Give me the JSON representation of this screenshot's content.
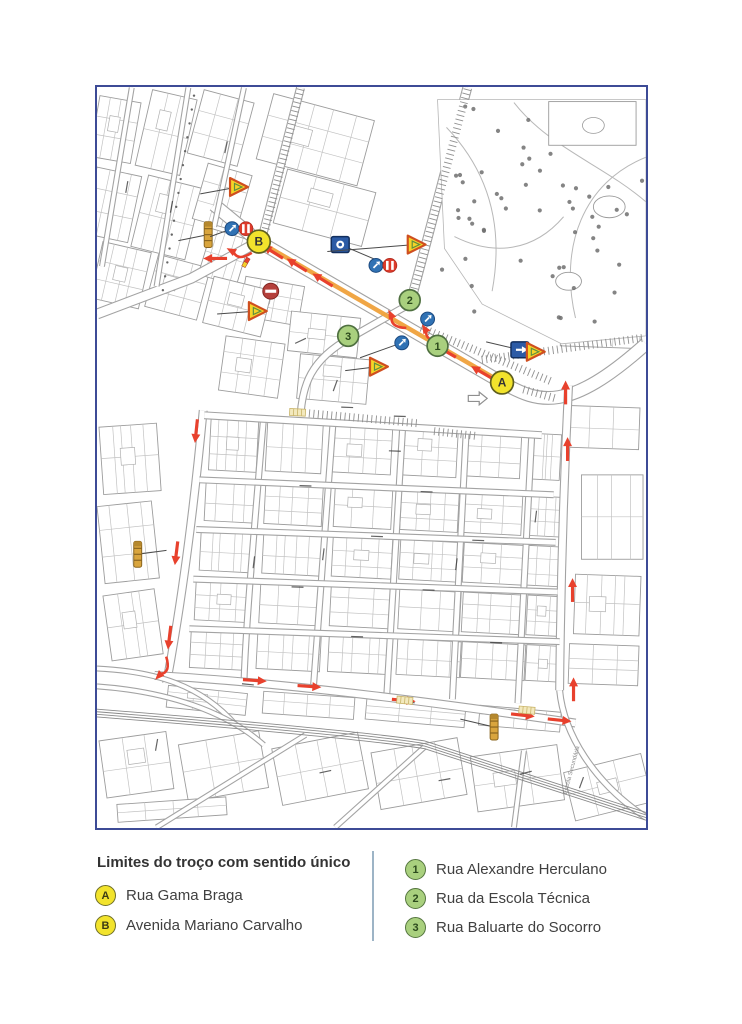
{
  "legend": {
    "title": "Limites do troço com sentido único",
    "divider_color": "#9db4c6",
    "left_items": [
      {
        "badge": "A",
        "name": "Rua Gama Braga",
        "badge_fill": "#f2e32c",
        "badge_border": "#6f6f28",
        "badge_text": "#3c3c14"
      },
      {
        "badge": "B",
        "name": "Avenida Mariano Carvalho",
        "badge_fill": "#f2e32c",
        "badge_border": "#6f6f28",
        "badge_text": "#3c3c14"
      }
    ],
    "right_items": [
      {
        "badge": "1",
        "name": "Rua Alexandre Herculano",
        "badge_fill": "#a9d07e",
        "badge_border": "#55763f",
        "badge_text": "#2c4a1d"
      },
      {
        "badge": "2",
        "name": "Rua da Escola Técnica",
        "badge_fill": "#a9d07e",
        "badge_border": "#55763f",
        "badge_text": "#2c4a1d"
      },
      {
        "badge": "3",
        "name": "Rua Baluarte do Socorro",
        "badge_fill": "#a9d07e",
        "badge_border": "#55763f",
        "badge_text": "#2c4a1d"
      }
    ]
  },
  "map": {
    "frame_color": "#3d4b96",
    "route": {
      "direction": "A→B",
      "band_color": "#f0a23c",
      "arrow_color": "#e8412d"
    },
    "colors": {
      "limit_marker": "#f2e32c",
      "street_marker": "#a9d07e",
      "sign_blue": "#2c5ba6",
      "sign_red": "#dd3b2b",
      "bollard_gold": "#d9a53e",
      "street_line": "#a3a3a3",
      "tree_dot": "#6f6f6f"
    },
    "markers": [
      {
        "label": "B",
        "x": 163,
        "y": 155,
        "kind": "limit"
      },
      {
        "label": "A",
        "x": 408,
        "y": 297,
        "kind": "limit"
      },
      {
        "label": "1",
        "x": 343,
        "y": 260,
        "kind": "street"
      },
      {
        "label": "2",
        "x": 315,
        "y": 214,
        "kind": "street"
      },
      {
        "label": "3",
        "x": 253,
        "y": 250,
        "kind": "street"
      }
    ],
    "signs": [
      {
        "type": "warning",
        "x": 142,
        "y": 100,
        "leader": [
          104,
          107
        ]
      },
      {
        "type": "bollard",
        "x": 112,
        "y": 148,
        "leader": [
          82,
          154
        ]
      },
      {
        "type": "bluecircle",
        "x": 136,
        "y": 142,
        "leader": [
          114,
          150
        ]
      },
      {
        "type": "redstriped",
        "x": 150,
        "y": 142
      },
      {
        "type": "noentry",
        "x": 175,
        "y": 205
      },
      {
        "type": "warning",
        "x": 161,
        "y": 225,
        "leader": [
          121,
          228
        ]
      },
      {
        "type": "bluesquare",
        "x": 245,
        "y": 158,
        "glyph": "badge",
        "leader": [
          292,
          178
        ]
      },
      {
        "type": "bluecircle",
        "x": 281,
        "y": 179
      },
      {
        "type": "redstriped",
        "x": 295,
        "y": 179
      },
      {
        "type": "warning",
        "x": 321,
        "y": 158,
        "leader": [
          232,
          165
        ]
      },
      {
        "type": "bluecircle",
        "x": 333,
        "y": 233
      },
      {
        "type": "bluecircle",
        "x": 307,
        "y": 257,
        "leader": [
          265,
          272
        ]
      },
      {
        "type": "warning",
        "x": 283,
        "y": 281,
        "leader": [
          250,
          285
        ]
      },
      {
        "type": "bluesquare",
        "x": 426,
        "y": 264,
        "glyph": "arrow",
        "leader": [
          392,
          256
        ]
      },
      {
        "type": "warning",
        "x": 441,
        "y": 266
      },
      {
        "type": "grayarrow",
        "x": 383,
        "y": 313
      },
      {
        "type": "bollard",
        "x": 41,
        "y": 470,
        "leader": [
          70,
          466
        ]
      },
      {
        "type": "bollard",
        "x": 400,
        "y": 644,
        "leader": [
          366,
          636
        ]
      },
      {
        "type": "crosswalk",
        "x": 202,
        "y": 327,
        "rot": 3
      },
      {
        "type": "crosswalk",
        "x": 310,
        "y": 617,
        "rot": 5
      },
      {
        "type": "crosswalk",
        "x": 433,
        "y": 627,
        "rot": 5
      },
      {
        "type": "endtick",
        "x": 150,
        "y": 176,
        "rot": 30
      }
    ],
    "flow_arrows": [
      {
        "x": 178,
        "y": 166,
        "a": 212
      },
      {
        "x": 202,
        "y": 179,
        "a": 212
      },
      {
        "x": 228,
        "y": 194,
        "a": 212
      },
      {
        "x": 352,
        "y": 266,
        "a": 210
      },
      {
        "x": 388,
        "y": 287,
        "a": 210
      },
      {
        "x": 120,
        "y": 172,
        "a": 180
      },
      {
        "x": 143,
        "y": 168,
        "a": 205,
        "c": 1
      },
      {
        "x": 300,
        "y": 236,
        "a": 240,
        "c": 1
      },
      {
        "x": 335,
        "y": 250,
        "a": 235,
        "c": 1
      },
      {
        "x": 100,
        "y": 345,
        "a": 96
      },
      {
        "x": 80,
        "y": 468,
        "a": 97
      },
      {
        "x": 73,
        "y": 553,
        "a": 97
      },
      {
        "x": 68,
        "y": 586,
        "a": 130,
        "c": 1
      },
      {
        "x": 158,
        "y": 597,
        "a": 4
      },
      {
        "x": 213,
        "y": 603,
        "a": 4
      },
      {
        "x": 308,
        "y": 617,
        "a": 5
      },
      {
        "x": 428,
        "y": 632,
        "a": 6
      },
      {
        "x": 465,
        "y": 637,
        "a": 6
      },
      {
        "x": 472,
        "y": 308,
        "a": 270
      },
      {
        "x": 474,
        "y": 365,
        "a": 270
      },
      {
        "x": 479,
        "y": 507,
        "a": 270
      },
      {
        "x": 480,
        "y": 607,
        "a": 270
      }
    ],
    "labels": [
      {
        "text": "Escola Secundária",
        "x": 473,
        "y": 712,
        "rot": -75
      }
    ]
  }
}
